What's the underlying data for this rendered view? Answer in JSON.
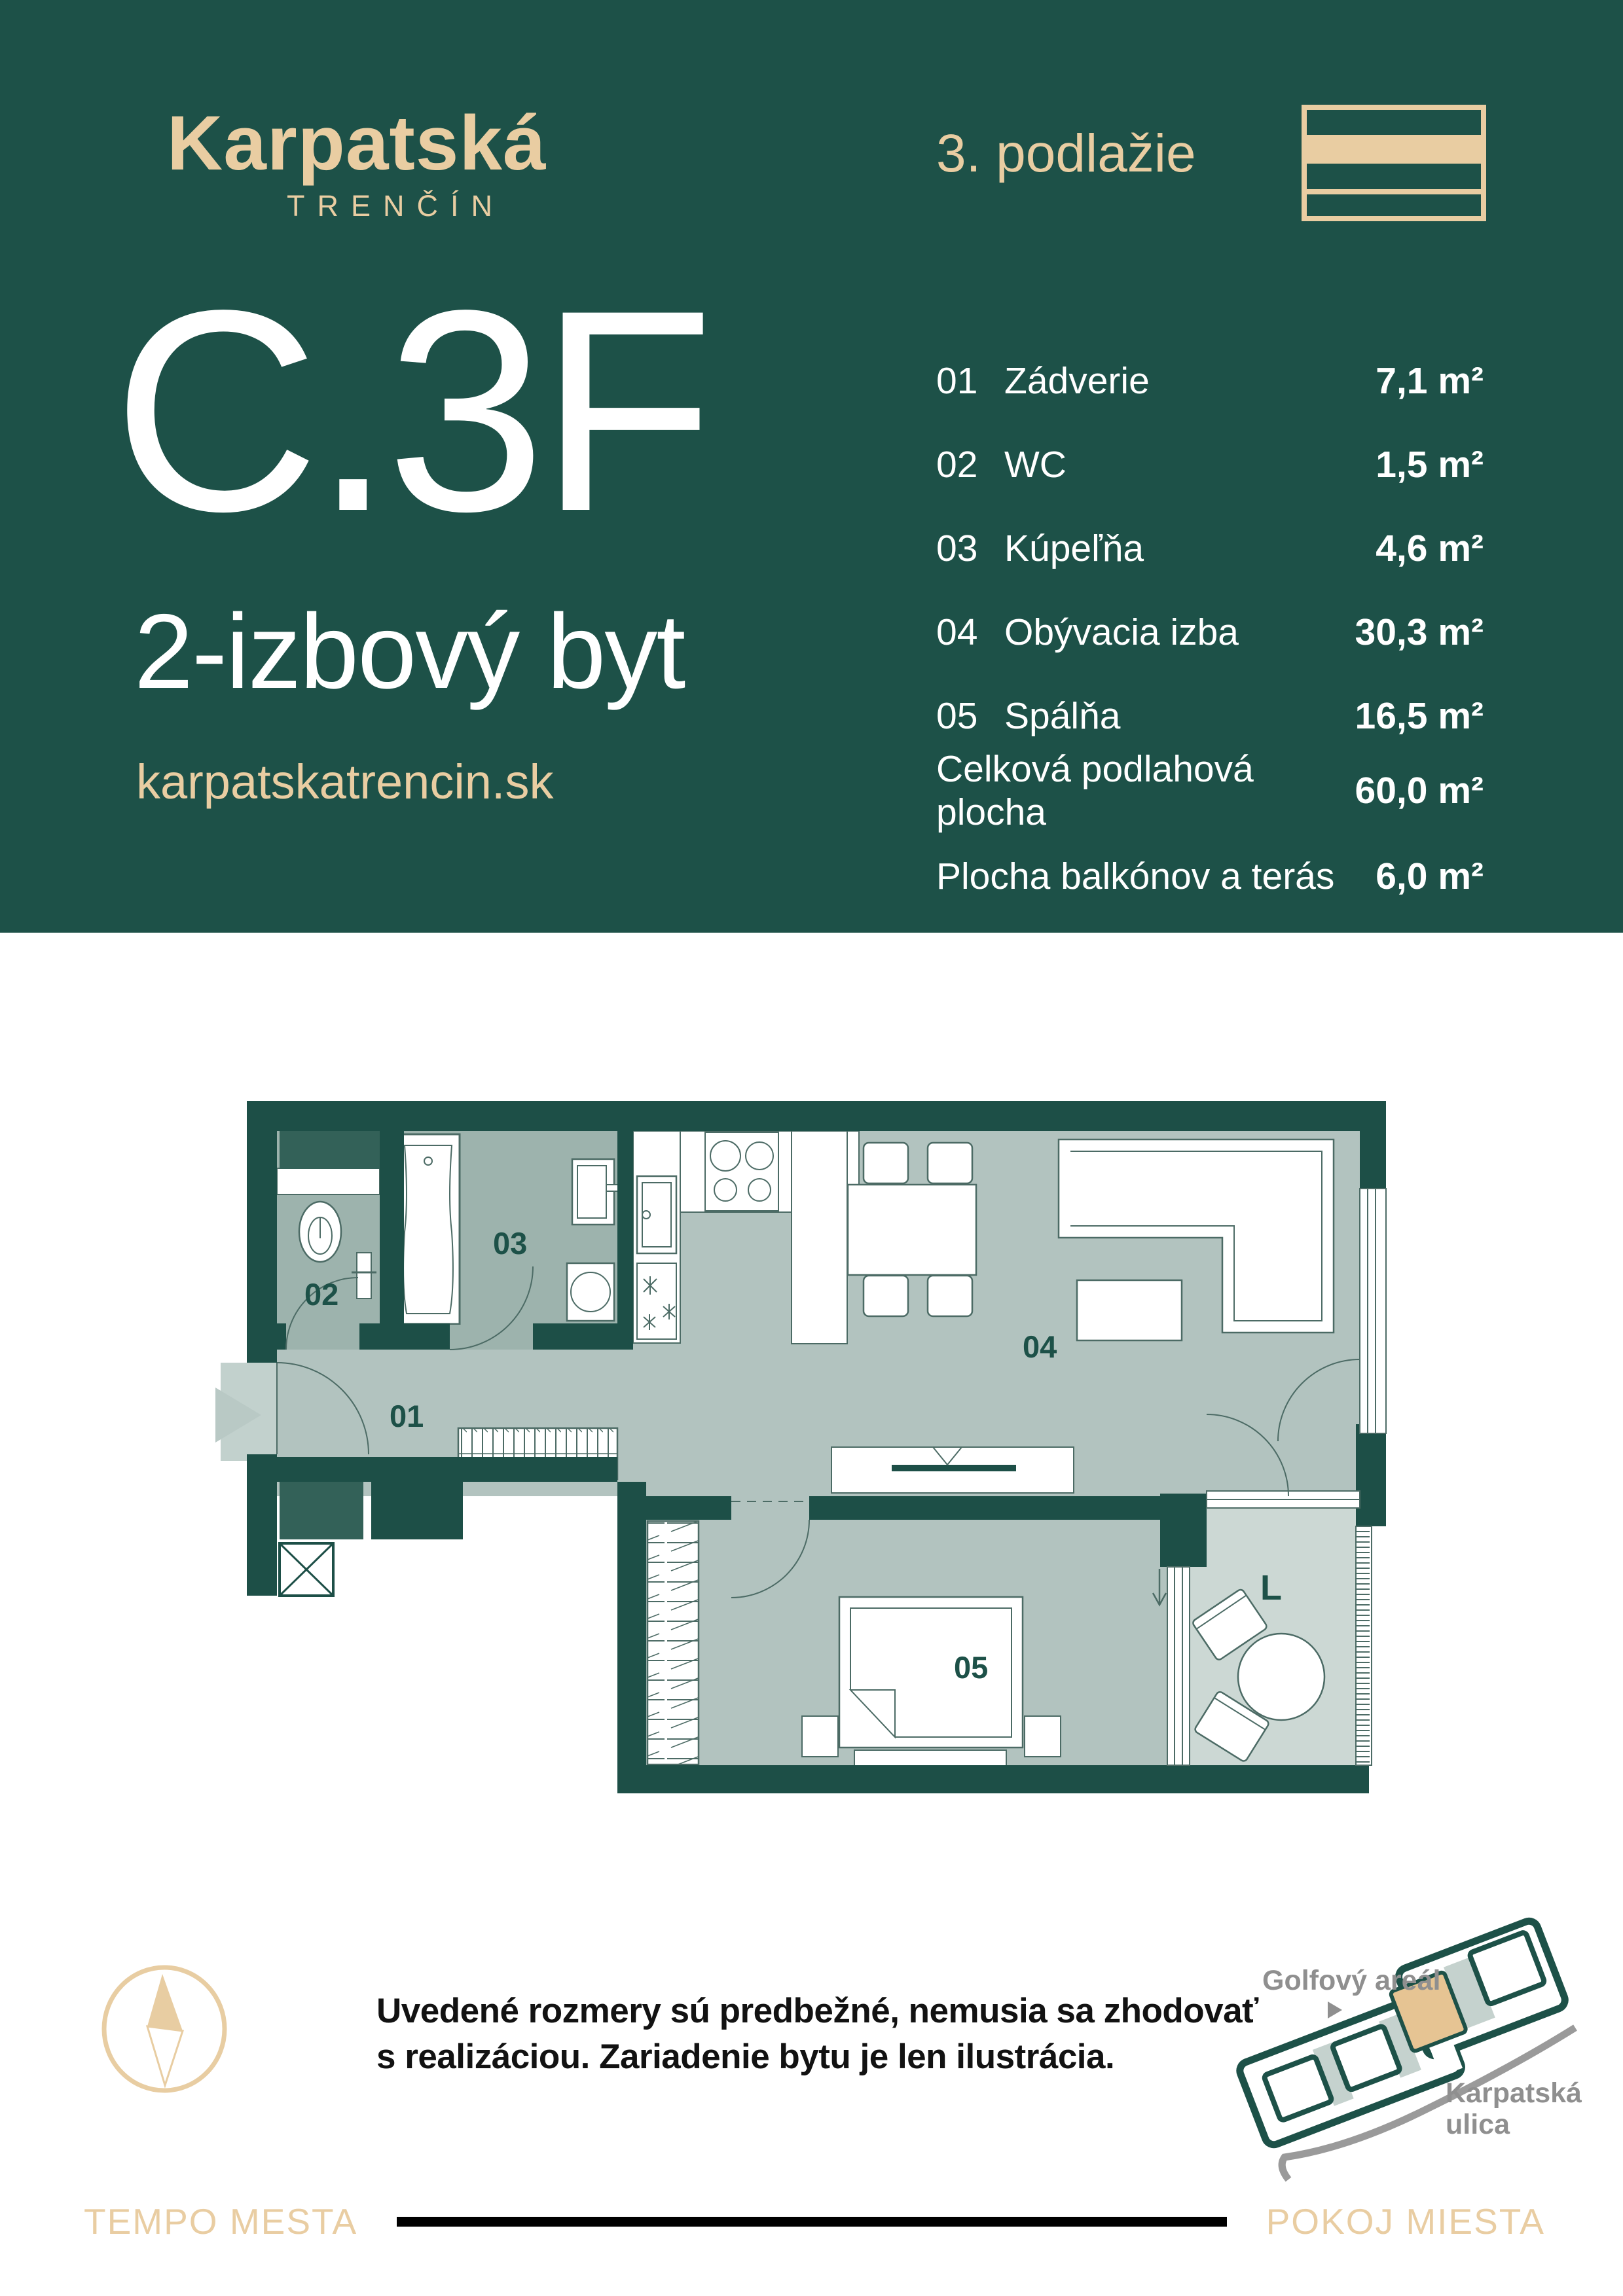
{
  "colors": {
    "header_teal": "#1d5148",
    "wall_teal": "#1d4f47",
    "beige": "#e9cda2",
    "room_gray": "#b2c3bf",
    "wet_room_gray": "#9db3ad",
    "loggia_gray": "#ccd8d4",
    "shaft_teal": "#336158",
    "minimap_unit_beige": "#e6c493",
    "minimap_gray_text": "#8f8f8f",
    "footer_line_black": "#000000"
  },
  "header": {
    "logo_title": "Karpatská",
    "logo_subtitle": "TRENČÍN",
    "floor_label": "3. podlažie",
    "unit_code": "C.3F",
    "unit_type": "2-izbový byt",
    "website": "karpatskatrencin.sk"
  },
  "rooms": [
    {
      "num": "01",
      "label": "Zádverie",
      "area": "7,1 m²"
    },
    {
      "num": "02",
      "label": "WC",
      "area": "1,5 m²"
    },
    {
      "num": "03",
      "label": "Kúpeľňa",
      "area": "4,6 m²"
    },
    {
      "num": "04",
      "label": "Obývacia izba",
      "area": "30,3 m²"
    },
    {
      "num": "05",
      "label": "Spálňa",
      "area": "16,5 m²"
    }
  ],
  "totals": [
    {
      "label": "Celková podlahová plocha",
      "value": "60,0 m²"
    },
    {
      "label": "Plocha balkónov a terás",
      "value": "6,0 m²"
    }
  ],
  "plan": {
    "labels": {
      "r01": "01",
      "r02": "02",
      "r03": "03",
      "r04": "04",
      "r05": "05",
      "loggia": "L"
    }
  },
  "disclaimer": {
    "line1": "Uvedené rozmery sú predbežné, nemusia sa zhodovať",
    "line2": "s realizáciou. Zariadenie bytu je len ilustrácia."
  },
  "minimap": {
    "area_label": "Golfový areál",
    "street_label_line1": "Karpatská",
    "street_label_line2": "ulica"
  },
  "footer": {
    "left": "TEMPO MESTA",
    "right": "POKOJ MIESTA"
  }
}
